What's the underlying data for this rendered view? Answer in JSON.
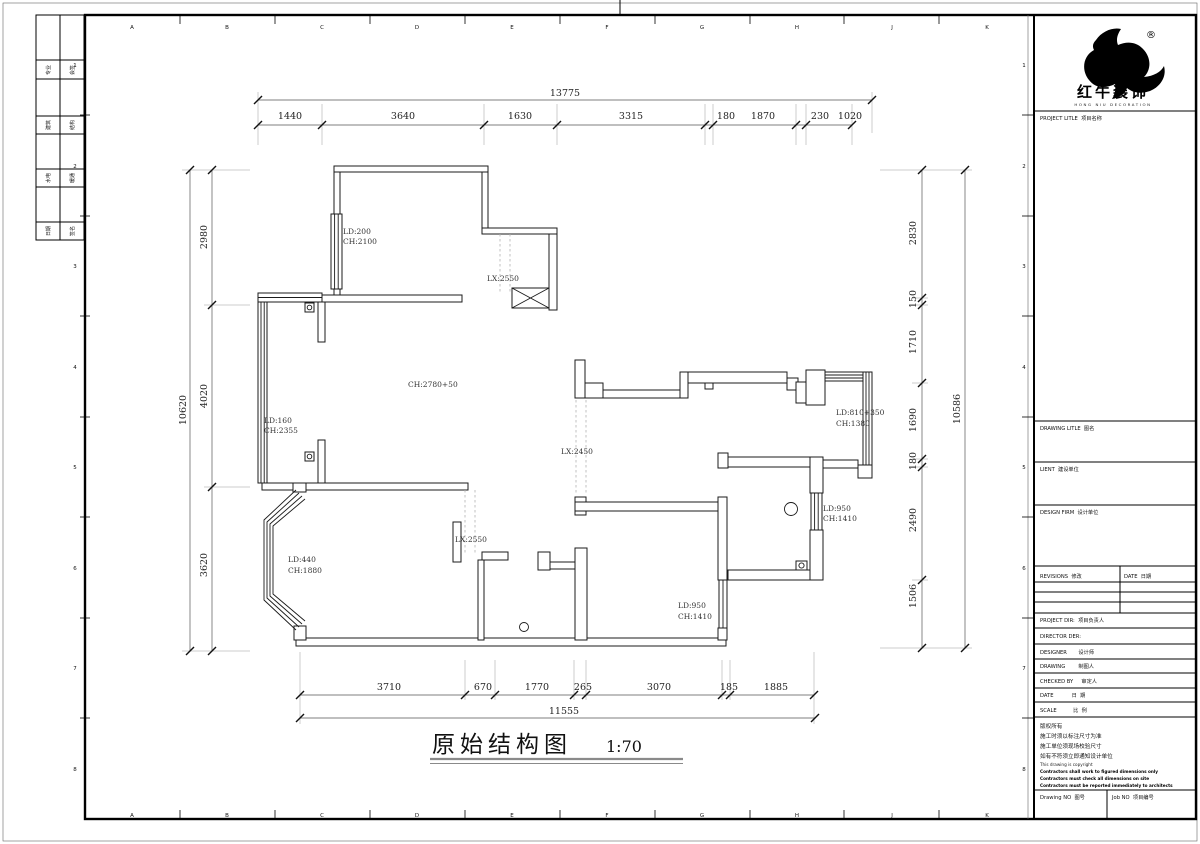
{
  "doc": {
    "title": "原始结构图",
    "scale": "1:70"
  },
  "brand": {
    "name": "红牛装饰",
    "sub": "HONG NIU DECORATION",
    "reg": "®"
  },
  "zones": {
    "letters": [
      "A",
      "B",
      "C",
      "D",
      "E",
      "F",
      "G",
      "H",
      "J",
      "K"
    ],
    "numbers": [
      "1",
      "2",
      "3",
      "4",
      "5",
      "6",
      "7",
      "8"
    ]
  },
  "sig": {
    "rows": [
      [
        "专业",
        "会签"
      ],
      [
        "建筑",
        "结构"
      ],
      [
        "水电",
        "暖通"
      ],
      [
        "日期",
        "签名"
      ]
    ]
  },
  "tb": {
    "project": "PROJECT LITLE  项目名称",
    "drawing_title": "DRAWING LITLE  图名",
    "client": "LIENT  建设单位",
    "firm": "DESIGN FIRM  设计单位",
    "revisions": "REVISIONS  修改",
    "date_col": "DATE  日期",
    "project_dir": "PROJECT DIR:  项目负责人",
    "director": "DIRECTOR DER:",
    "designer": "DESIGNER       设计师",
    "drawn": "DRAWING        制图人",
    "checked": "CHECKED BY     审定人",
    "date": "DATE           日  期",
    "scale": "SCALE          比  例",
    "c1": "版权所有",
    "c2": "施工时须以标注尺寸为准",
    "c3": "施工单位须现场校验尺寸",
    "c4": "如有不符须立即通知设计单位",
    "c5": "This drawing is copyright",
    "c6": "Contractors shall work to figured dimensions only",
    "c7": "Contractors must check all dimensions on site",
    "c8": "Contractors must be reported immediately to architects",
    "drawing_no": "Drawing NO  图号",
    "job_no": "Job NO  项目编号"
  },
  "dims": {
    "top_total": "13775",
    "top": [
      "1440",
      "3640",
      "1630",
      "3315",
      "180",
      "1870",
      "230",
      "1020"
    ],
    "left_total": "10620",
    "left": [
      "2980",
      "4020",
      "3620"
    ],
    "right_total": "10586",
    "right": [
      "2830",
      "150",
      "1710",
      "1690",
      "180",
      "2490",
      "1506"
    ],
    "bottom_total": "11555",
    "bottom": [
      "3710",
      "670",
      "1770",
      "265",
      "3070",
      "185",
      "1885"
    ]
  },
  "labels": {
    "tl_ld": "LD:200",
    "tl_ch": "CH:2100",
    "lx1": "LX:2550",
    "hall": "CH:2780+50",
    "lw_ld": "LD:160",
    "lw_ch": "CH:2355",
    "lx2": "LX:2450",
    "lx3": "LX:2550",
    "bay_ld": "LD:440",
    "bay_ch": "CH:1880",
    "bath_ld": "LD:950",
    "bath_ch": "CH:1410",
    "br_ld": "LD:950",
    "br_ch": "CH:1410",
    "tr_ld": "LD:810+350",
    "tr_ch": "CH:1380"
  }
}
